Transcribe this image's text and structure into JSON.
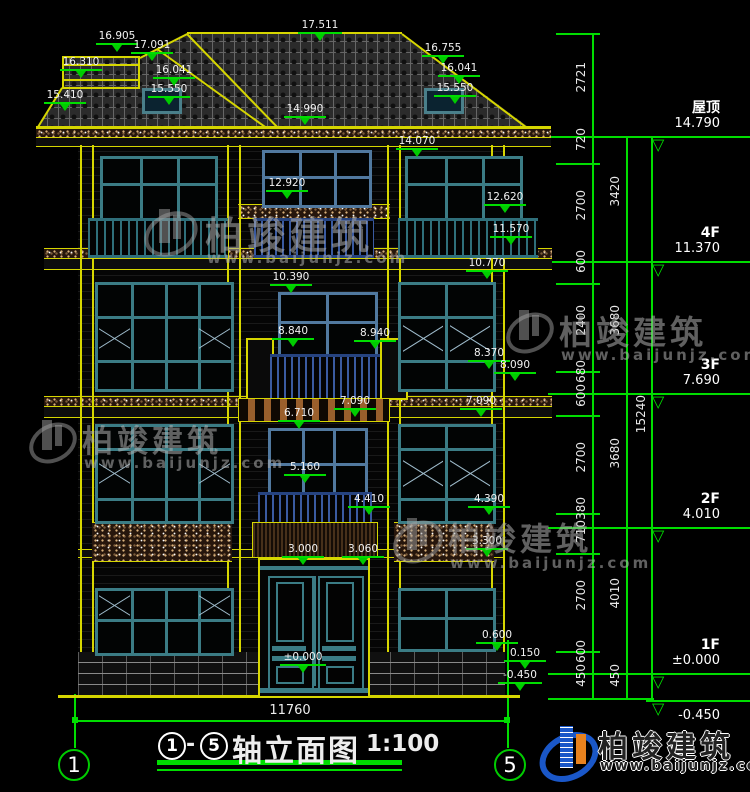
{
  "drawing": {
    "title_prefix": "1",
    "title_dash": "-",
    "title_suffix": "5",
    "title_text": "轴立面图",
    "title_scale": "1:100",
    "bottom_width_dim": "11760",
    "grid_left": "1",
    "grid_right": "5"
  },
  "floor_levels": [
    {
      "label": "屋顶",
      "value": "14.790"
    },
    {
      "label": "4F",
      "value": "11.370"
    },
    {
      "label": "3F",
      "value": "7.690"
    },
    {
      "label": "2F",
      "value": "4.010"
    },
    {
      "label": "1F",
      "value": "±0.000"
    },
    {
      "label": "",
      "value": "-0.450"
    }
  ],
  "dim_inner": [
    "2721",
    "720",
    "2700",
    "600",
    "2400",
    "680",
    "600",
    "2700",
    "380",
    "710",
    "2700",
    "600",
    "450"
  ],
  "dim_mid": [
    "3420",
    "3680",
    "3680",
    "4010",
    "450"
  ],
  "dim_total": "15240",
  "elevation_marks": [
    {
      "v": "17.511"
    },
    {
      "v": "16.905"
    },
    {
      "v": "17.091"
    },
    {
      "v": "16.310"
    },
    {
      "v": "16.041"
    },
    {
      "v": "15.550"
    },
    {
      "v": "15.410"
    },
    {
      "v": "16.755"
    },
    {
      "v": "16.041"
    },
    {
      "v": "15.550"
    },
    {
      "v": "14.990"
    },
    {
      "v": "14.070"
    },
    {
      "v": "12.920"
    },
    {
      "v": "12.620"
    },
    {
      "v": "11.570"
    },
    {
      "v": "10.770"
    },
    {
      "v": "10.390"
    },
    {
      "v": "8.840"
    },
    {
      "v": "8.940"
    },
    {
      "v": "8.370"
    },
    {
      "v": "8.090"
    },
    {
      "v": "7.090"
    },
    {
      "v": "7.090"
    },
    {
      "v": "6.710"
    },
    {
      "v": "5.160"
    },
    {
      "v": "4.410"
    },
    {
      "v": "4.390"
    },
    {
      "v": "3.300"
    },
    {
      "v": "3.000"
    },
    {
      "v": "3.060"
    },
    {
      "v": "0.600"
    },
    {
      "v": "0.150"
    },
    {
      "v": "±0.000"
    },
    {
      "v": "-0.450"
    }
  ],
  "watermark": {
    "name": "柏竣建筑",
    "url": "www.baijunjz.com"
  },
  "logo": {
    "name": "柏竣建筑",
    "url": "www.baijunjz.com"
  },
  "colors": {
    "cad_yellow": "#d6d600",
    "cad_green": "#00dd00",
    "frame_teal": "#3b7c85",
    "frame_blue": "#51799f",
    "railing_blue": "#26437f",
    "brand_blue": "#1a57c8",
    "brand_orange": "#e8821e"
  }
}
